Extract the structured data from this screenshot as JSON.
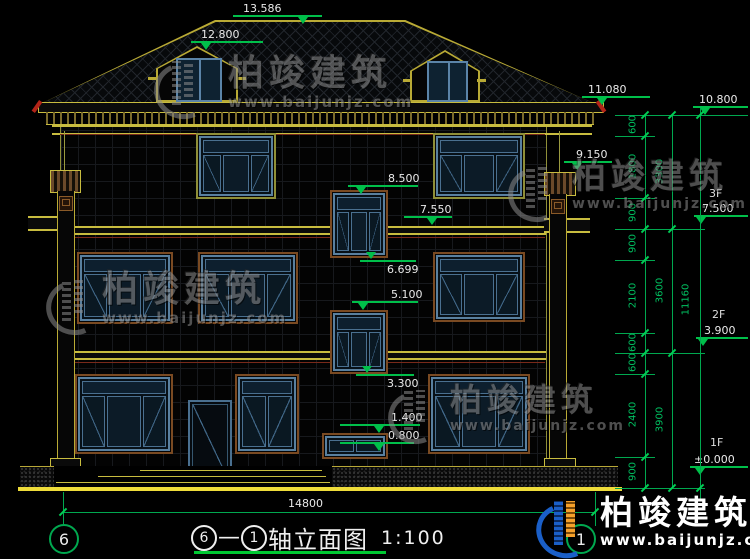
{
  "drawing": {
    "title": {
      "axis_a": "6",
      "dash": "—",
      "axis_b": "1",
      "text": "轴立面图",
      "scale": "1:100"
    },
    "axis_bubbles": {
      "left": "6",
      "right": "1"
    },
    "ground_dim": "14800"
  },
  "markers": [
    {
      "id": "ridge",
      "value": "13.586"
    },
    {
      "id": "dormer",
      "value": "12.800"
    },
    {
      "id": "eave-top",
      "value": "11.080"
    },
    {
      "id": "parapet",
      "value": "10.800"
    },
    {
      "id": "capital",
      "value": "9.150"
    },
    {
      "id": "win3f-top",
      "value": "8.500"
    },
    {
      "id": "slab3",
      "value": "7.550"
    },
    {
      "id": "stairwin-sill",
      "value": "6.699"
    },
    {
      "id": "stairwin2-top",
      "value": "5.100"
    },
    {
      "id": "stairwin2-sill",
      "value": "3.300"
    },
    {
      "id": "smallwin-top",
      "value": "1.400"
    },
    {
      "id": "smallwin-sill",
      "value": "0.800"
    }
  ],
  "floors": [
    {
      "label": "3F",
      "value": "7.500"
    },
    {
      "label": "2F",
      "value": "3.900"
    },
    {
      "label": "1F",
      "value": "±0.000"
    }
  ],
  "dims": {
    "col1": [
      "600",
      "1800",
      "900",
      "900",
      "2100",
      "600",
      "600",
      "2400",
      "900"
    ],
    "col2": [
      "3300",
      "3600",
      "3900"
    ],
    "col3": [
      "11160"
    ]
  },
  "watermark": {
    "brand": "柏竣建筑",
    "url": "www.baijunjz.com"
  },
  "colors": {
    "line_yellow": "#c8bc3f",
    "line_green": "#00bf4a",
    "accent_red": "#b22418",
    "frame_blue": "#5b84a8",
    "frame_brown": "#7a4a22",
    "logo_blue": "#1a5fc8",
    "logo_orange": "#f5a02a",
    "ground_yellow": "#eedc3a"
  }
}
